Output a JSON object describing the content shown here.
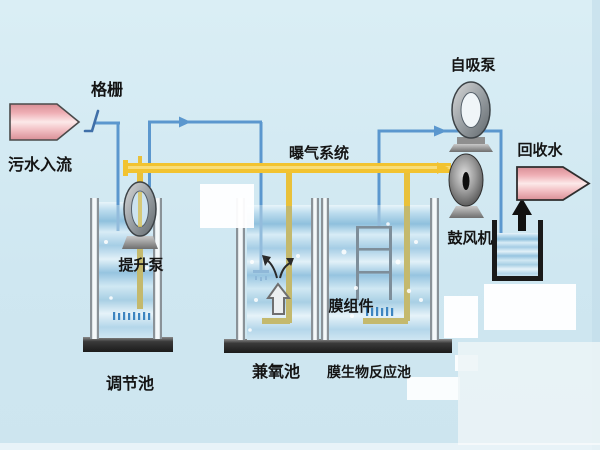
{
  "labels": {
    "screen": "格栅",
    "inflow": "污水入流",
    "lift_pump": "提升泵",
    "regulating_tank": "调节池",
    "aeration_system": "曝气系统",
    "facultative_tank": "兼氧池",
    "membrane_module": "膜组件",
    "mbr_tank": "膜生物反应池",
    "self_priming_pump": "自吸泵",
    "blower": "鼓风机",
    "recycled_water": "回收水"
  },
  "colors": {
    "background": "#d8edf4",
    "water_pipe_blue": "#5b97ce",
    "underwater_pipe_blue": "#93bcdc",
    "air_pipe_yellow": "#f2c330",
    "underwater_pipe_olive": "#c4b96d",
    "pink_arrow": "#efb0b6",
    "tank_water": "#a5cde5",
    "tank_base_dark": "#2a2a2a",
    "pump_metal_gray": "#8e979c"
  }
}
